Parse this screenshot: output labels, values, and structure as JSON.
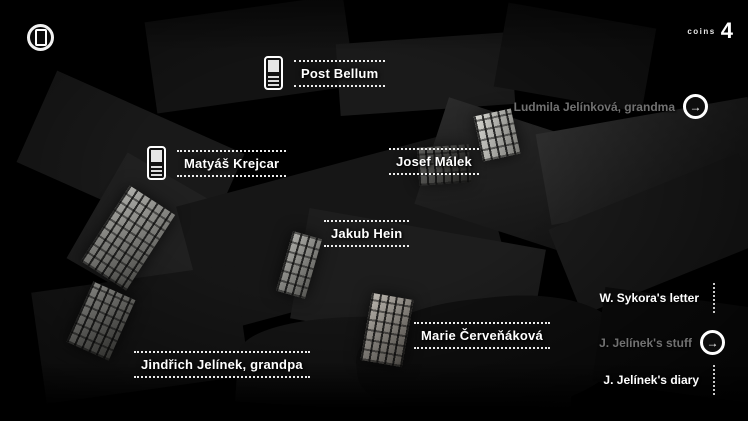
{
  "hud": {
    "coins_label": "coins",
    "coins_value": "4"
  },
  "markers": {
    "post_bellum": {
      "label": "Post Bellum",
      "type": "phone-contact"
    },
    "matyas_krejcar": {
      "label": "Matyáš Krejcar",
      "type": "phone-contact"
    },
    "josef_malek": {
      "label": "Josef Málek",
      "type": "place"
    },
    "jakub_hein": {
      "label": "Jakub Hein",
      "type": "place"
    },
    "marie_cervenakova": {
      "label": "Marie Červeňáková",
      "type": "place"
    },
    "jindrich_jelinek": {
      "label": "Jindřich Jelínek, grandpa",
      "type": "place"
    }
  },
  "side_items": {
    "ludmila": {
      "label": "Ludmila Jelínková, grandma",
      "state": "visited"
    },
    "sykora_letter": {
      "label": "W. Sykora's letter",
      "state": "available"
    },
    "jelinek_stuff": {
      "label": "J. Jelínek's stuff",
      "state": "visited"
    },
    "jelinek_diary": {
      "label": "J. Jelínek's diary",
      "state": "available"
    }
  },
  "icons": {
    "menu": "phone-in-circle",
    "visited_arrow": "arrow-right-in-circle",
    "arrow_glyph": "→",
    "marker_phone": "mobile-phone"
  },
  "colors": {
    "background": "#000000",
    "label_text": "#ffffff",
    "visited_text": "#717171",
    "facade_light": "#90908a"
  }
}
